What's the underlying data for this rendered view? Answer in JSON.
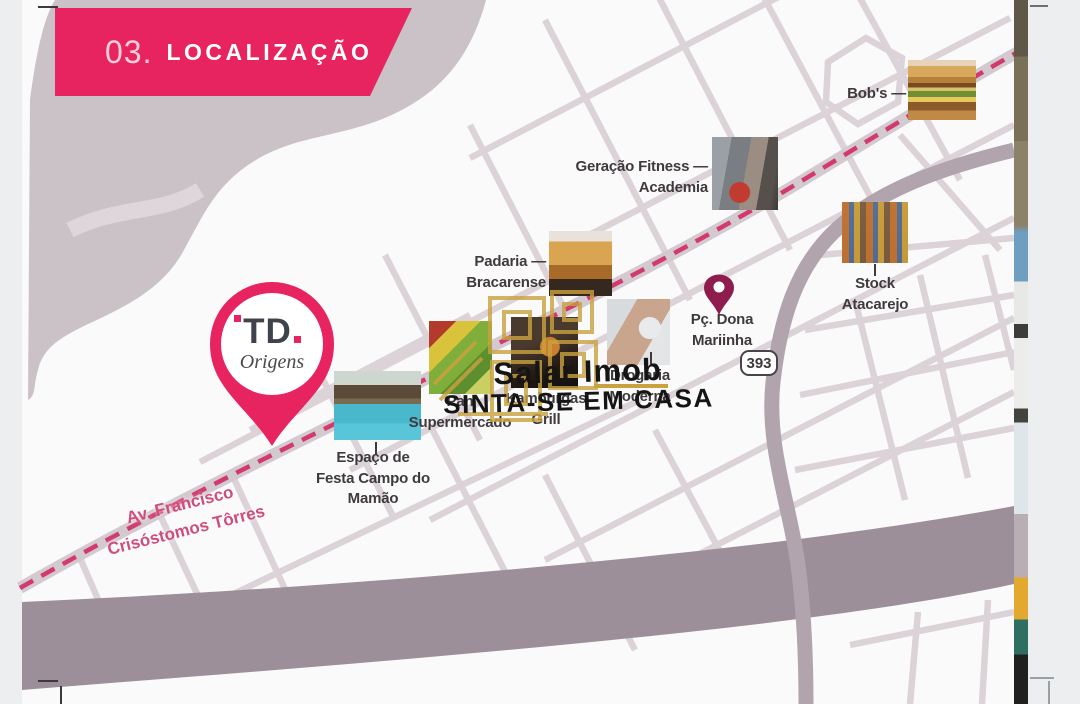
{
  "header": {
    "number": "03.",
    "title": "LOCALIZAÇÃO"
  },
  "development": {
    "brand": "TD",
    "brand_line2": "Origens"
  },
  "roads": {
    "shield": "393",
    "avenue_line1": "Av. Francisco",
    "avenue_line2": "Crisóstomos Tôrres"
  },
  "landmarks": {
    "bobs": {
      "label": "Bob's —"
    },
    "geracao": {
      "line1": "Geração Fitness —",
      "line2": "Academia"
    },
    "padaria": {
      "line1": "Padaria —",
      "line2": "Bracarense"
    },
    "stock": {
      "line1": "Stock",
      "line2": "Atacarejo"
    },
    "pan": {
      "line1": "Pan",
      "line2": "Supermercado"
    },
    "grill": {
      "line1": "Kamburgas",
      "line2": "Grill"
    },
    "drogaria": {
      "line1": "Drogaria",
      "line2": "Moderna"
    },
    "espaco": {
      "line1": "Espaço de",
      "line2": "Festa Campo do",
      "line3": "Mamão"
    },
    "praca": {
      "line1": "Pç. Dona",
      "line2": "Mariinha"
    }
  },
  "watermark": {
    "brand": "Salar Imob",
    "tagline": "SINTA-SE EM CASA"
  },
  "colors": {
    "accent_pink": "#E7245F",
    "route_pink": "#D23A6F",
    "map_terrain": "#CBC2C8",
    "road_major": "#B2A4AD",
    "river_band": "#9D8F99",
    "watermark_gold": "#C9A23F",
    "label_text": "#3F3A3D",
    "praca_pin": "#8E1C4C"
  }
}
